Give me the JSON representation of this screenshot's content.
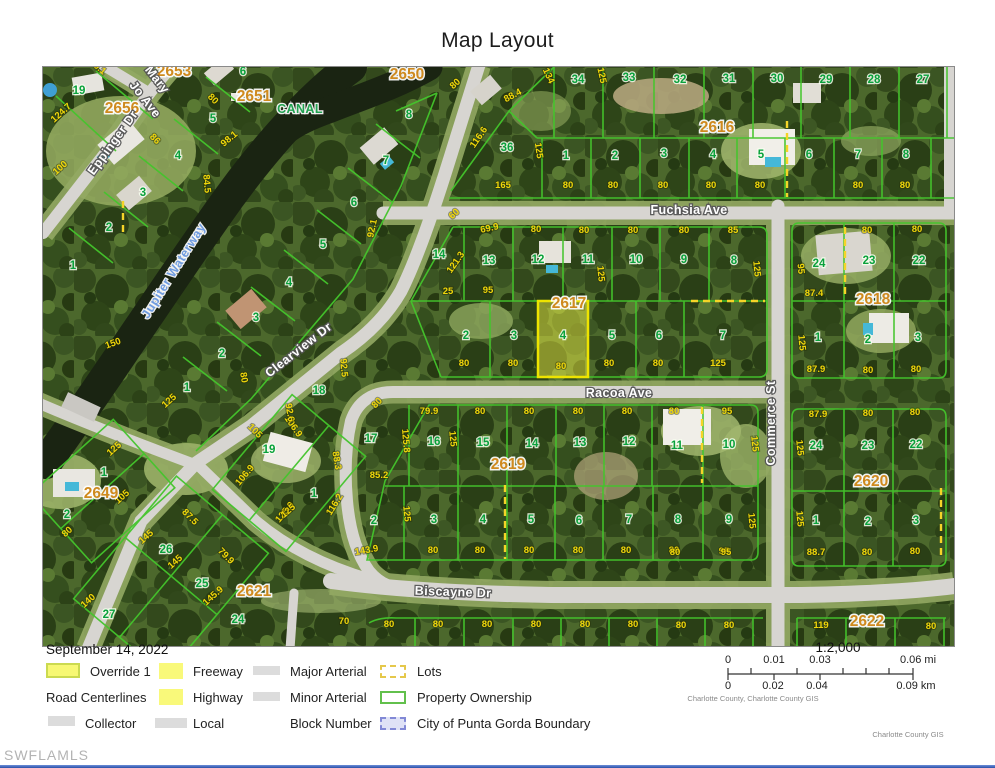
{
  "title": "Map Layout",
  "map": {
    "street_labels": [
      [
        "Fuchsia Ave",
        688,
        213,
        0,
        "road",
        13
      ],
      [
        "Racoa Ave",
        618,
        396,
        0,
        "road",
        13.5
      ],
      [
        "Biscayne Dr",
        452,
        595,
        2,
        "road",
        15
      ],
      [
        "Commerce St",
        774,
        422,
        -90,
        "road",
        12
      ],
      [
        "Clearview Dr",
        300,
        352,
        -38,
        "road",
        12
      ],
      [
        "Eppinger Dr",
        115,
        144,
        -54,
        "road",
        12
      ],
      [
        "Mary",
        153,
        81,
        52,
        "road",
        12
      ],
      [
        "Jo Ave",
        141,
        101,
        52,
        "road",
        12
      ],
      [
        "Jupiter Waterway",
        176,
        272,
        -58,
        "water",
        13
      ],
      [
        "CANAL",
        299,
        112,
        0,
        "canal",
        13.5
      ]
    ],
    "block_numbers": [
      [
        "2653",
        173,
        75
      ],
      [
        "2656",
        121,
        112
      ],
      [
        "2651",
        253,
        100
      ],
      [
        "2650",
        406,
        78
      ],
      [
        "2616",
        716,
        131
      ],
      [
        "2617",
        568,
        307
      ],
      [
        "2618",
        872,
        303
      ],
      [
        "2619",
        507,
        468
      ],
      [
        "2620",
        870,
        485
      ],
      [
        "2621",
        253,
        595
      ],
      [
        "2622",
        866,
        625
      ],
      [
        "2649",
        100,
        497
      ]
    ],
    "parcel_numbers": [
      [
        "19",
        78,
        93
      ],
      [
        "6",
        242,
        74
      ],
      [
        "5",
        212,
        121
      ],
      [
        "4",
        177,
        158
      ],
      [
        "3",
        142,
        195
      ],
      [
        "2",
        108,
        230
      ],
      [
        "1",
        72,
        268
      ],
      [
        "8",
        408,
        117
      ],
      [
        "7",
        385,
        163
      ],
      [
        "6",
        353,
        205
      ],
      [
        "5",
        322,
        247
      ],
      [
        "4",
        288,
        285
      ],
      [
        "3",
        255,
        320
      ],
      [
        "2",
        221,
        356
      ],
      [
        "1",
        186,
        390
      ],
      [
        "36",
        506,
        150
      ],
      [
        "34",
        577,
        82
      ],
      [
        "33",
        628,
        80
      ],
      [
        "32",
        679,
        82
      ],
      [
        "31",
        728,
        81
      ],
      [
        "30",
        776,
        81
      ],
      [
        "29",
        825,
        82
      ],
      [
        "28",
        873,
        82
      ],
      [
        "27",
        922,
        82
      ],
      [
        "1",
        565,
        158
      ],
      [
        "2",
        614,
        158
      ],
      [
        "3",
        663,
        156
      ],
      [
        "4",
        712,
        157
      ],
      [
        "5",
        760,
        157
      ],
      [
        "6",
        808,
        157
      ],
      [
        "7",
        857,
        157
      ],
      [
        "8",
        905,
        157
      ],
      [
        "14",
        438,
        257
      ],
      [
        "13",
        488,
        263
      ],
      [
        "12",
        537,
        262
      ],
      [
        "11",
        587,
        262
      ],
      [
        "10",
        635,
        262
      ],
      [
        "9",
        683,
        262
      ],
      [
        "8",
        733,
        263
      ],
      [
        "2",
        465,
        338
      ],
      [
        "3",
        513,
        338
      ],
      [
        "4",
        562,
        338
      ],
      [
        "5",
        611,
        338
      ],
      [
        "6",
        658,
        338
      ],
      [
        "7",
        722,
        338
      ],
      [
        "24",
        818,
        266
      ],
      [
        "23",
        868,
        263
      ],
      [
        "22",
        918,
        263
      ],
      [
        "1",
        817,
        340
      ],
      [
        "2",
        867,
        342
      ],
      [
        "3",
        917,
        340
      ],
      [
        "17",
        370,
        441
      ],
      [
        "16",
        433,
        444
      ],
      [
        "15",
        482,
        445
      ],
      [
        "14",
        531,
        446
      ],
      [
        "13",
        579,
        445
      ],
      [
        "12",
        628,
        444
      ],
      [
        "11",
        676,
        448
      ],
      [
        "10",
        728,
        447
      ],
      [
        "2",
        373,
        523
      ],
      [
        "3",
        433,
        522
      ],
      [
        "4",
        482,
        522
      ],
      [
        "5",
        530,
        522
      ],
      [
        "6",
        578,
        523
      ],
      [
        "7",
        628,
        522
      ],
      [
        "8",
        677,
        522
      ],
      [
        "9",
        728,
        522
      ],
      [
        "24",
        815,
        448
      ],
      [
        "23",
        867,
        448
      ],
      [
        "22",
        915,
        447
      ],
      [
        "1",
        815,
        523
      ],
      [
        "2",
        867,
        524
      ],
      [
        "3",
        915,
        523
      ],
      [
        "18",
        318,
        393
      ],
      [
        "19",
        268,
        452
      ],
      [
        "1",
        313,
        496
      ],
      [
        "1",
        103,
        475
      ],
      [
        "2",
        66,
        517
      ],
      [
        "26",
        165,
        552
      ],
      [
        "25",
        201,
        586
      ],
      [
        "27",
        108,
        617
      ],
      [
        "24",
        237,
        622
      ]
    ],
    "dimensions": [
      [
        "80.1",
        95,
        68,
        40
      ],
      [
        "124.7",
        62,
        114,
        -42
      ],
      [
        "80",
        210,
        100,
        45
      ],
      [
        "100",
        61,
        169,
        -42
      ],
      [
        "98.1",
        230,
        140,
        -40
      ],
      [
        "84.5",
        203,
        183,
        85
      ],
      [
        "86",
        152,
        140,
        45
      ],
      [
        "150",
        113,
        345,
        -20
      ],
      [
        "125",
        170,
        402,
        -42
      ],
      [
        "80",
        240,
        377,
        80
      ],
      [
        "92.5",
        340,
        367,
        85
      ],
      [
        "80",
        456,
        85,
        -42
      ],
      [
        "88.4",
        513,
        97,
        -28
      ],
      [
        "134",
        545,
        76,
        65
      ],
      [
        "125",
        598,
        75,
        78
      ],
      [
        "116.6",
        480,
        138,
        -55
      ],
      [
        "125",
        535,
        150,
        82
      ],
      [
        "92.1",
        374,
        228,
        -78
      ],
      [
        "60",
        455,
        215,
        -42
      ],
      [
        "69.9",
        489,
        230,
        -12
      ],
      [
        "165",
        502,
        187,
        0
      ],
      [
        "80",
        567,
        187,
        0
      ],
      [
        "80",
        612,
        187,
        0
      ],
      [
        "80",
        662,
        187,
        0
      ],
      [
        "80",
        710,
        187,
        0
      ],
      [
        "80",
        759,
        187,
        0
      ],
      [
        "80",
        857,
        187,
        0
      ],
      [
        "80",
        904,
        187,
        0
      ],
      [
        "80",
        683,
        232,
        0
      ],
      [
        "85",
        732,
        232,
        0
      ],
      [
        "80",
        535,
        231,
        0
      ],
      [
        "80",
        583,
        232,
        0
      ],
      [
        "80",
        632,
        232,
        0
      ],
      [
        "80",
        866,
        232,
        0
      ],
      [
        "80",
        916,
        231,
        0
      ],
      [
        "25",
        447,
        293,
        0
      ],
      [
        "95",
        487,
        292,
        0
      ],
      [
        "121.3",
        457,
        263,
        -55
      ],
      [
        "125",
        597,
        273,
        85
      ],
      [
        "125",
        753,
        268,
        85
      ],
      [
        "80",
        463,
        365,
        0
      ],
      [
        "80",
        512,
        365,
        0
      ],
      [
        "80",
        560,
        368,
        0
      ],
      [
        "80",
        608,
        365,
        0
      ],
      [
        "80",
        657,
        365,
        0
      ],
      [
        "125",
        717,
        365,
        0
      ],
      [
        "95",
        797,
        268,
        85
      ],
      [
        "87.4",
        813,
        295,
        0
      ],
      [
        "125",
        798,
        342,
        85
      ],
      [
        "87.9",
        815,
        371,
        0
      ],
      [
        "80",
        867,
        372,
        0
      ],
      [
        "80",
        915,
        371,
        0
      ],
      [
        "79.9",
        428,
        413,
        0
      ],
      [
        "80",
        479,
        413,
        0
      ],
      [
        "80",
        528,
        413,
        0
      ],
      [
        "80",
        577,
        413,
        0
      ],
      [
        "80",
        626,
        413,
        0
      ],
      [
        "80",
        378,
        404,
        -45
      ],
      [
        "80",
        673,
        413,
        0
      ],
      [
        "95",
        726,
        413,
        0
      ],
      [
        "85.2",
        378,
        477,
        0
      ],
      [
        "125.8",
        402,
        440,
        85
      ],
      [
        "125",
        449,
        438,
        85
      ],
      [
        "125",
        751,
        443,
        85
      ],
      [
        "116.2",
        336,
        505,
        -58
      ],
      [
        "125",
        403,
        513,
        85
      ],
      [
        "143.9",
        366,
        552,
        -10
      ],
      [
        "80",
        432,
        552,
        0
      ],
      [
        "80",
        479,
        552,
        0
      ],
      [
        "80",
        528,
        552,
        0
      ],
      [
        "80",
        577,
        552,
        0
      ],
      [
        "80",
        625,
        552,
        0
      ],
      [
        "80",
        673,
        552,
        0
      ],
      [
        "95",
        723,
        553,
        0
      ],
      [
        "125",
        748,
        520,
        85
      ],
      [
        "87.9",
        817,
        416,
        0
      ],
      [
        "80",
        867,
        415,
        0
      ],
      [
        "80",
        914,
        414,
        0
      ],
      [
        "125",
        796,
        447,
        85
      ],
      [
        "125",
        796,
        518,
        85
      ],
      [
        "88.7",
        815,
        554,
        0
      ],
      [
        "80",
        866,
        554,
        0
      ],
      [
        "80",
        914,
        553,
        0
      ],
      [
        "80",
        674,
        554,
        0
      ],
      [
        "95",
        725,
        554,
        0
      ],
      [
        "125",
        115,
        450,
        -42
      ],
      [
        "105",
        123,
        498,
        -42
      ],
      [
        "80",
        68,
        533,
        -42
      ],
      [
        "145",
        147,
        538,
        -42
      ],
      [
        "87.5",
        187,
        518,
        45
      ],
      [
        "145",
        176,
        563,
        -42
      ],
      [
        "79.9",
        223,
        557,
        45
      ],
      [
        "145.9",
        214,
        597,
        -42
      ],
      [
        "140",
        89,
        602,
        -42
      ],
      [
        "105",
        252,
        432,
        45
      ],
      [
        "106.9",
        290,
        427,
        55
      ],
      [
        "106.9",
        246,
        476,
        -50
      ],
      [
        "125.9",
        286,
        513,
        -50
      ],
      [
        "92.6",
        286,
        412,
        80
      ],
      [
        "88.3",
        333,
        460,
        80
      ],
      [
        "125",
        289,
        512,
        -42
      ],
      [
        "70",
        343,
        623,
        0
      ],
      [
        "80",
        388,
        626,
        0
      ],
      [
        "80",
        437,
        626,
        0
      ],
      [
        "80",
        486,
        626,
        0
      ],
      [
        "80",
        535,
        626,
        0
      ],
      [
        "80",
        584,
        626,
        0
      ],
      [
        "80",
        632,
        626,
        0
      ],
      [
        "80",
        680,
        627,
        0
      ],
      [
        "80",
        728,
        627,
        0
      ],
      [
        "119",
        820,
        627,
        0
      ],
      [
        "80",
        930,
        628,
        0
      ]
    ],
    "highlight_parcel": {
      "block": "2617",
      "lot": "4"
    }
  },
  "legend": {
    "date": "September 14, 2022",
    "items": [
      {
        "label": "Override 1"
      },
      {
        "label": "Freeway"
      },
      {
        "label": "Major Arterial"
      },
      {
        "label": "Lots"
      },
      {
        "label": "Road Centerlines"
      },
      {
        "label": "Highway"
      },
      {
        "label": "Minor Arterial"
      },
      {
        "label": "Property Ownership"
      },
      {
        "label": "Collector"
      },
      {
        "label": "Local"
      },
      {
        "label": "Block Number"
      },
      {
        "label": "City of Punta Gorda Boundary"
      }
    ]
  },
  "scale": {
    "ratio": "1:2,000",
    "mi_ticks": [
      "0",
      "0.01",
      "0.03",
      "0.06 mi"
    ],
    "km_ticks": [
      "0",
      "0.02",
      "0.04",
      "0.09 km"
    ],
    "credit_line1": "Charlotte County, Charlotte County GIS",
    "credit_line2": "Charlotte County GIS"
  },
  "watermark": "SWFLAMLS"
}
